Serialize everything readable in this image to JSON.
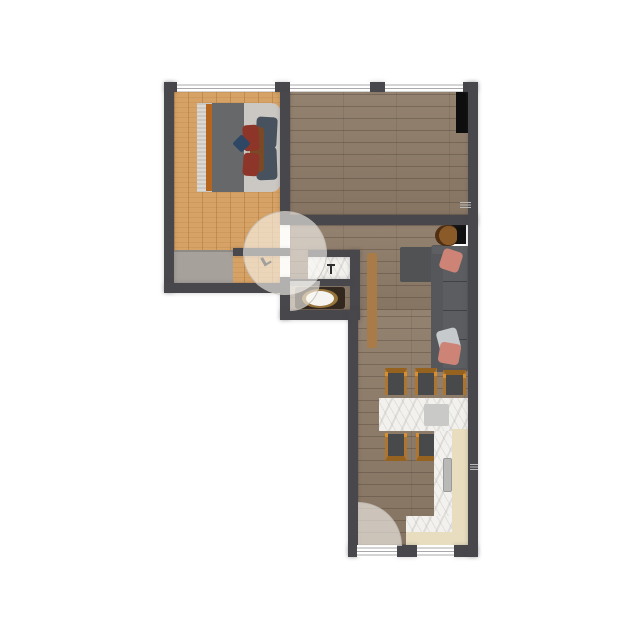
{
  "canvas": {
    "width": 640,
    "height": 640,
    "background": "#ffffff",
    "content": "apartment-floorplan-top-view"
  },
  "palette": {
    "wall": "#48474b",
    "window_fill": "#ffffff",
    "window_line": "#a9a9ab",
    "floor_bedroom": "#d7a265",
    "floor_main": "#8e7b68",
    "door_arc": "rgba(250,248,244,0.60)",
    "wardrobe_gray": "#a7a19b",
    "black_unit": "#0e0e0e",
    "bed_base": "#cbc7c2",
    "bed_fringe": "#dcd9d4",
    "bed_stripe_orange": "#b5651d",
    "bed_blanket": "#66686a",
    "pillow_maroon": "#8e3529",
    "pillow_brown": "#7a4a27",
    "pillow_slate": "#47525e",
    "pillow_navy": "#2d4764",
    "sofa": "#55575b",
    "sofa_chaise": "#505254",
    "sofa_cushion": "#5b5d61",
    "pillow_salmon": "#cd8476",
    "pillow_light_gray": "#c6cacd",
    "desk_top": "#111111",
    "desk_frame": "#ffffff",
    "chair_leather": "#8a5a28",
    "sideboard": "#a87b49",
    "chair_wood": "#ad752f",
    "chair_seat": "#48494b",
    "marble": "#f3f1ed",
    "cabinet_beige": "#e8ddbf",
    "appliance_gray": "#b9bab8",
    "toilet_surround": "#32281e",
    "toilet_ring": "#96743a",
    "toilet_seat": "#f6f4f1",
    "table_object": "#c9c9c7"
  },
  "rooms": [
    {
      "id": "bedroom",
      "floor": "light-oak-planks",
      "position": "top-left"
    },
    {
      "id": "top-right-room",
      "floor": "gray-brown-planks",
      "position": "top-right"
    },
    {
      "id": "living-hallway",
      "floor": "gray-brown-planks",
      "position": "middle-right"
    },
    {
      "id": "bathroom",
      "floor": "gray-brown-planks",
      "position": "center"
    },
    {
      "id": "kitchen-dining",
      "floor": "gray-brown-planks",
      "position": "bottom-right"
    }
  ],
  "furniture": [
    {
      "id": "double-bed",
      "room": "bedroom",
      "details": "gray blanket, orange stripe, fringed throw, maroon-brown-slate pillows"
    },
    {
      "id": "wardrobe",
      "room": "bedroom",
      "details": "light gray, along bottom wall"
    },
    {
      "id": "black-unit",
      "room": "top-right-room",
      "details": "black rectangle on right wall"
    },
    {
      "id": "desk-with-chair",
      "room": "living-hallway",
      "details": "black desk, white frame, brown chair"
    },
    {
      "id": "corner-sofa",
      "room": "living-hallway",
      "details": "dark gray L-sofa with salmon and gray pillows"
    },
    {
      "id": "sideboard",
      "room": "living-hallway",
      "details": "narrow tan plank"
    },
    {
      "id": "sink-counter",
      "room": "bathroom",
      "details": "white marble with faucet"
    },
    {
      "id": "toilet",
      "room": "bathroom",
      "details": "white oval seat, gold ring, dark surround"
    },
    {
      "id": "dining-table",
      "room": "kitchen-dining",
      "details": "white marble, gray object on top"
    },
    {
      "id": "dining-chairs",
      "room": "kitchen-dining",
      "count": 5,
      "details": "wood frame, dark gray seats"
    },
    {
      "id": "kitchen-counter",
      "room": "kitchen-dining",
      "details": "L-shaped beige cabinets with marble top and gray appliance"
    }
  ],
  "openings": {
    "windows": [
      {
        "id": "window-bedroom-top",
        "wall": "top"
      },
      {
        "id": "window-room-top-1",
        "wall": "top"
      },
      {
        "id": "window-room-top-2",
        "wall": "top"
      },
      {
        "id": "window-kitchen-1",
        "wall": "bottom"
      },
      {
        "id": "window-kitchen-2",
        "wall": "bottom"
      }
    ],
    "doors": [
      {
        "id": "bedroom-door",
        "swing": "full-circle-arc"
      },
      {
        "id": "bathroom-door",
        "swing": "quarter-arc"
      },
      {
        "id": "entry-door",
        "swing": "quarter-arc",
        "location": "bottom-left-of-kitchen"
      }
    ]
  }
}
